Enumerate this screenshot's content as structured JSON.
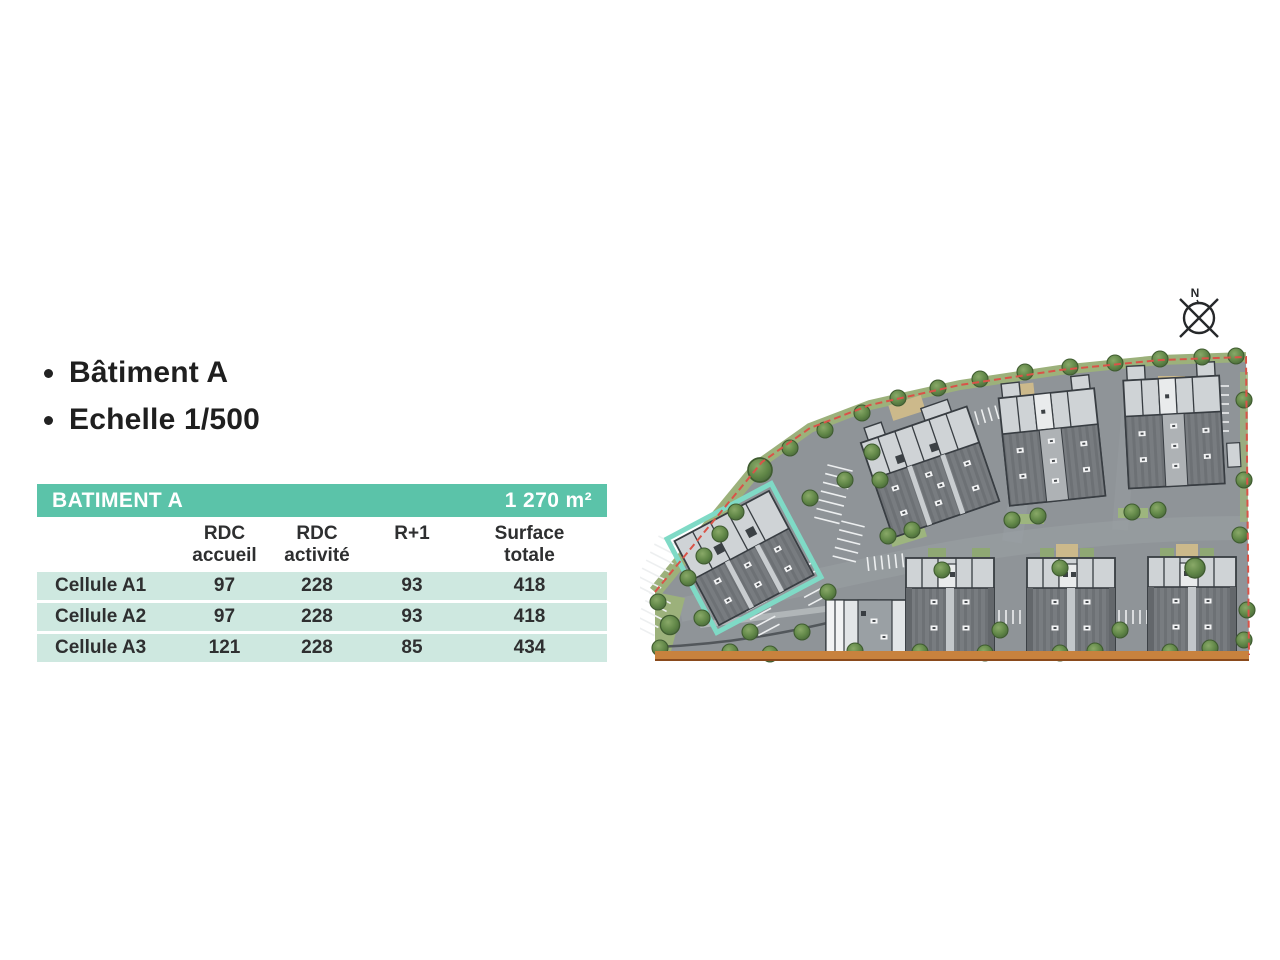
{
  "bullets": {
    "items": [
      {
        "label": "Bâtiment A"
      },
      {
        "label": "Echelle 1/500"
      }
    ]
  },
  "table": {
    "title": "BATIMENT A",
    "total_area": "1 270 m²",
    "columns": {
      "col1_line1": "RDC",
      "col1_line2": "accueil",
      "col2_line1": "RDC",
      "col2_line2": "activité",
      "col3_line1": "R+1",
      "col4_line1": "Surface",
      "col4_line2": "totale"
    },
    "rows": [
      {
        "label": "Cellule A1",
        "rdc_accueil": "97",
        "rdc_activite": "228",
        "r_plus_1": "93",
        "surface_totale": "418"
      },
      {
        "label": "Cellule A2",
        "rdc_accueil": "97",
        "rdc_activite": "228",
        "r_plus_1": "93",
        "surface_totale": "418"
      },
      {
        "label": "Cellule A3",
        "rdc_accueil": "121",
        "rdc_activite": "228",
        "r_plus_1": "85",
        "surface_totale": "434"
      }
    ]
  },
  "site_plan": {
    "compass_label": "N"
  },
  "colors": {
    "header_teal": "#5bc3a9",
    "row_teal": "#cee8e0",
    "highlight_teal": "#7fdac6",
    "boundary_red": "#d95348",
    "boundary_orange": "#c8823e",
    "asphalt_gray": "#8f9498",
    "building_light": "#cfd3d6",
    "roof_dark": "#7a7e82",
    "tree_green": "#5f8546"
  }
}
